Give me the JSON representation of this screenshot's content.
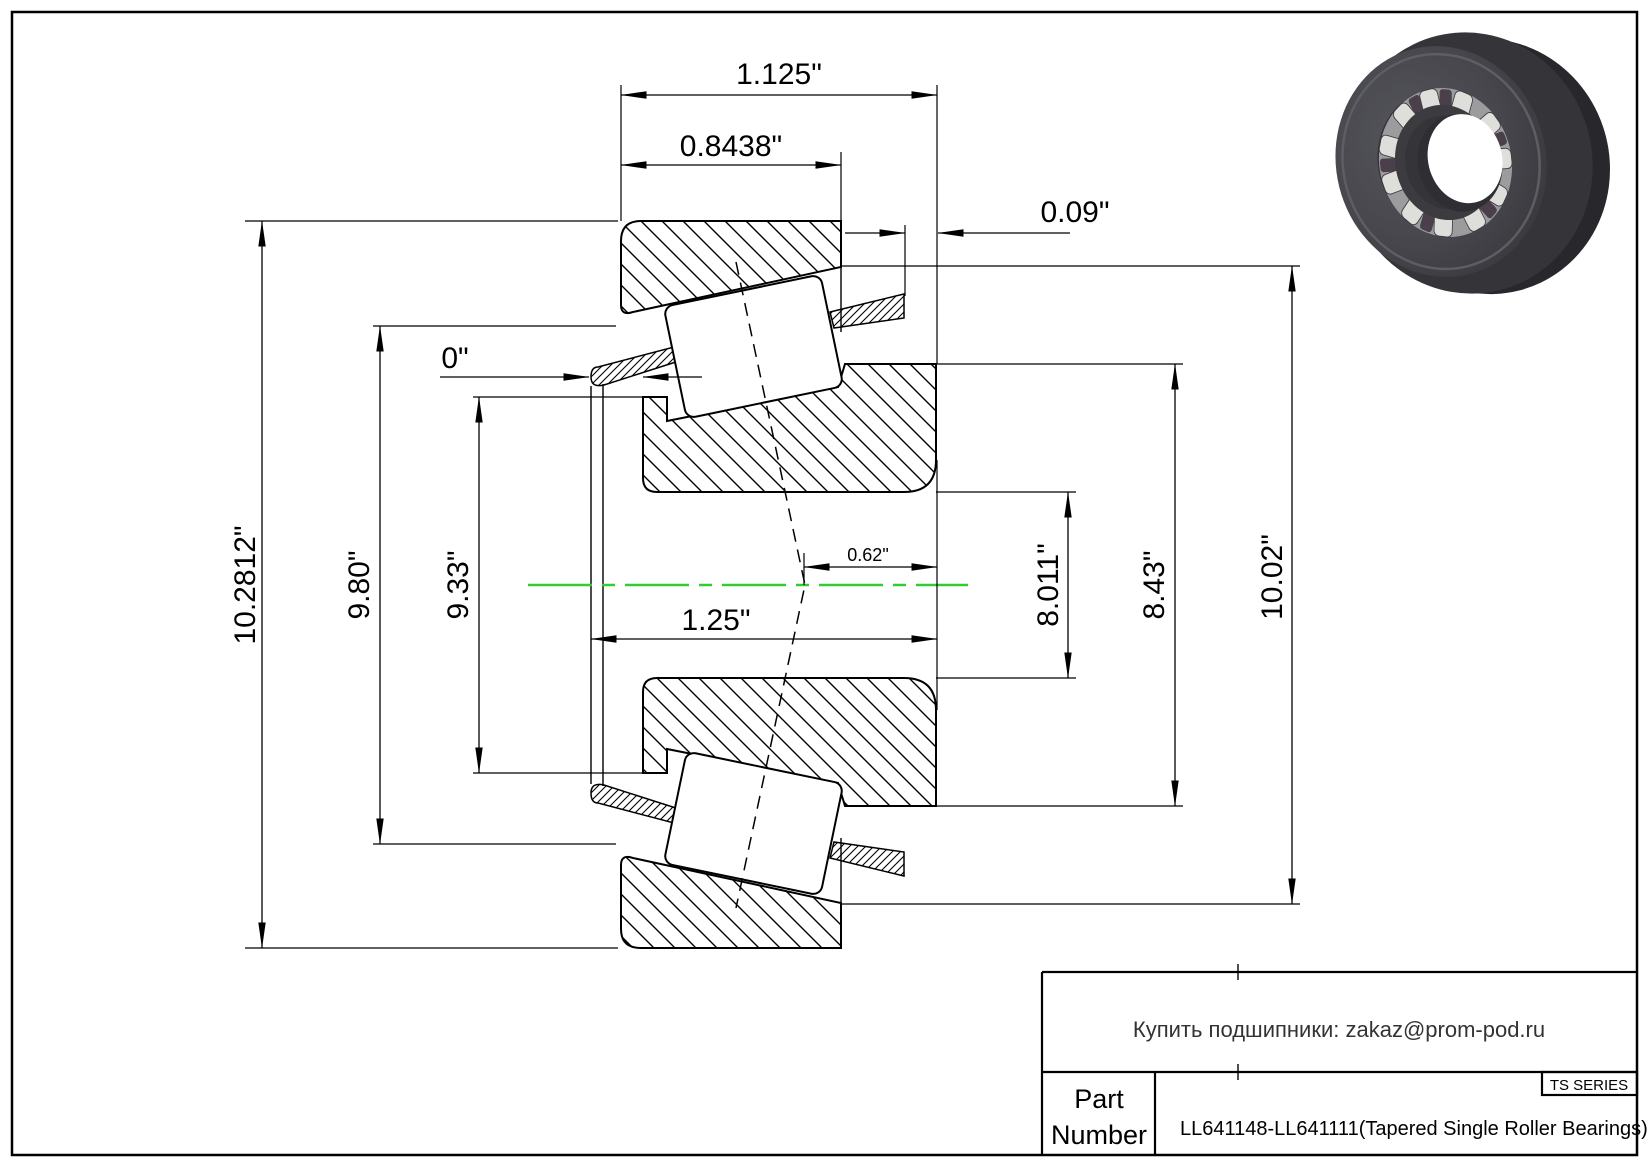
{
  "page": {
    "background": "#ffffff",
    "line_color": "#000000",
    "centerline_color": "#33cc33"
  },
  "drawing": {
    "type": "tapered-roller-bearing-cross-section",
    "dims": {
      "total_width": "1.125\"",
      "cup_width": "0.8438\"",
      "cage_protrusion": "0.09\"",
      "front_face_gap": "0\"",
      "outside_diameter": "10.2812\"",
      "diameter_980": "9.80\"",
      "diameter_933": "9.33\"",
      "length_125": "1.25\"",
      "offset_062": "0.62\"",
      "diameter_8011": "8.011\"",
      "diameter_843": "8.43\"",
      "diameter_1002": "10.02\""
    }
  },
  "title_block": {
    "contact": "Купить подшипники: zakaz@prom-pod.ru",
    "series": "TS SERIES",
    "part_label_line1": "Part",
    "part_label_line2": "Number",
    "part_number": "LL641148-LL641111(Tapered Single Roller Bearings)"
  }
}
